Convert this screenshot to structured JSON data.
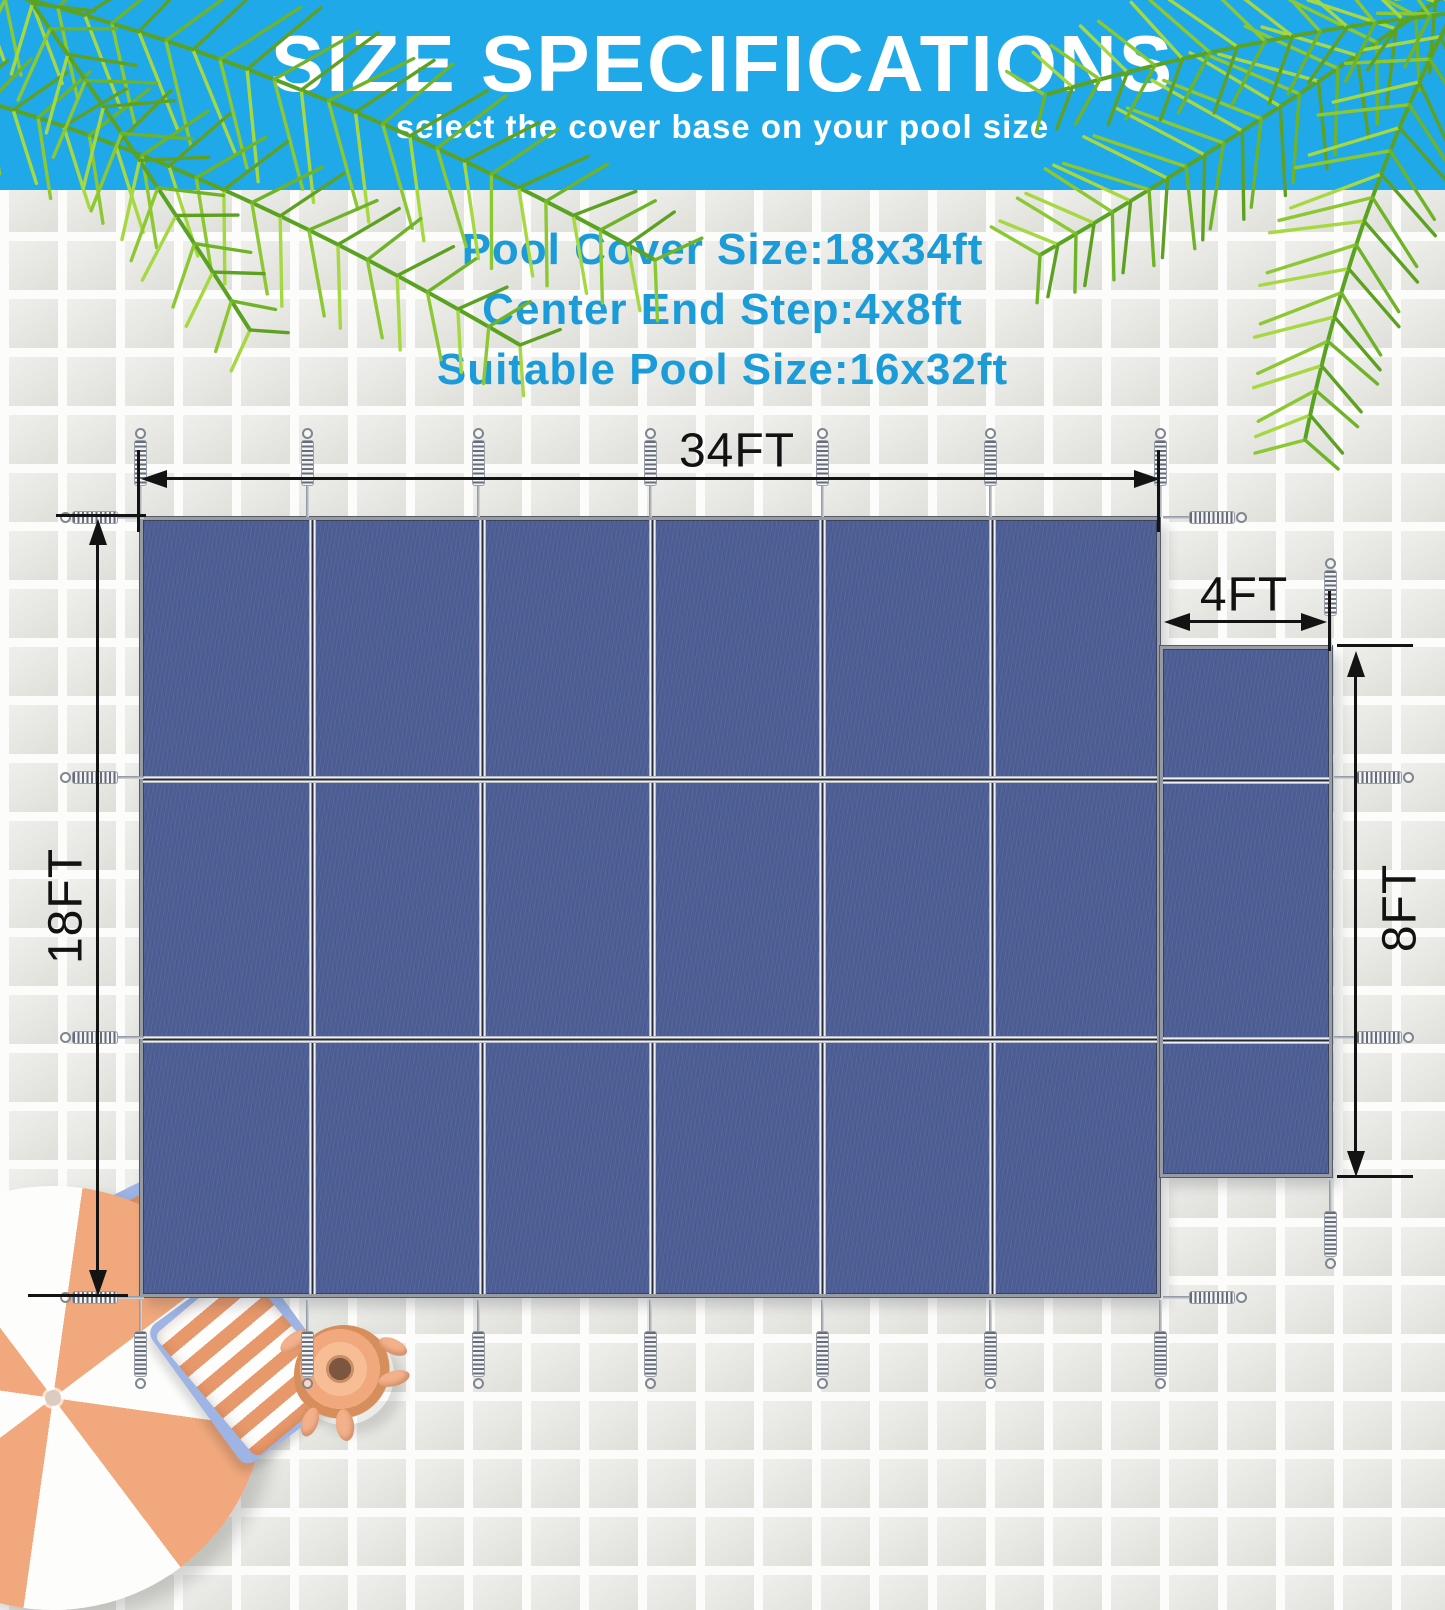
{
  "banner": {
    "title": "SIZE SPECIFICATIONS",
    "subtitle": "select the cover base on your pool size",
    "background_color": "#1fa9e9",
    "text_color": "#ffffff"
  },
  "pool_specs": {
    "text_color": "#1b9cd9",
    "lines": [
      "Pool Cover Size:18x34ft",
      "Center End Step:4x8ft",
      "Suitable Pool Size:16x32ft"
    ]
  },
  "diagram": {
    "cover": {
      "fabric_color": "#4d5e95",
      "panel_columns": 6,
      "panel_rows": 3,
      "step_panel_rows": 3
    },
    "dimensions": {
      "cover_width": "34FT",
      "cover_height": "18FT",
      "step_width": "4FT",
      "step_height": "8FT"
    },
    "hardware": {
      "icon": "tension-spring",
      "spring_count": 24
    }
  },
  "decorations": {
    "palm_leaf_colors": [
      "#8cc832",
      "#6fb428",
      "#a6d842",
      "#5ea122"
    ],
    "umbrella_colors": [
      "#ffffff",
      "#f0a87c"
    ],
    "towel_colors": [
      "#e8996b",
      "#ffffff",
      "#9db4e4"
    ],
    "swim_ring_color": "#f2b28c"
  }
}
